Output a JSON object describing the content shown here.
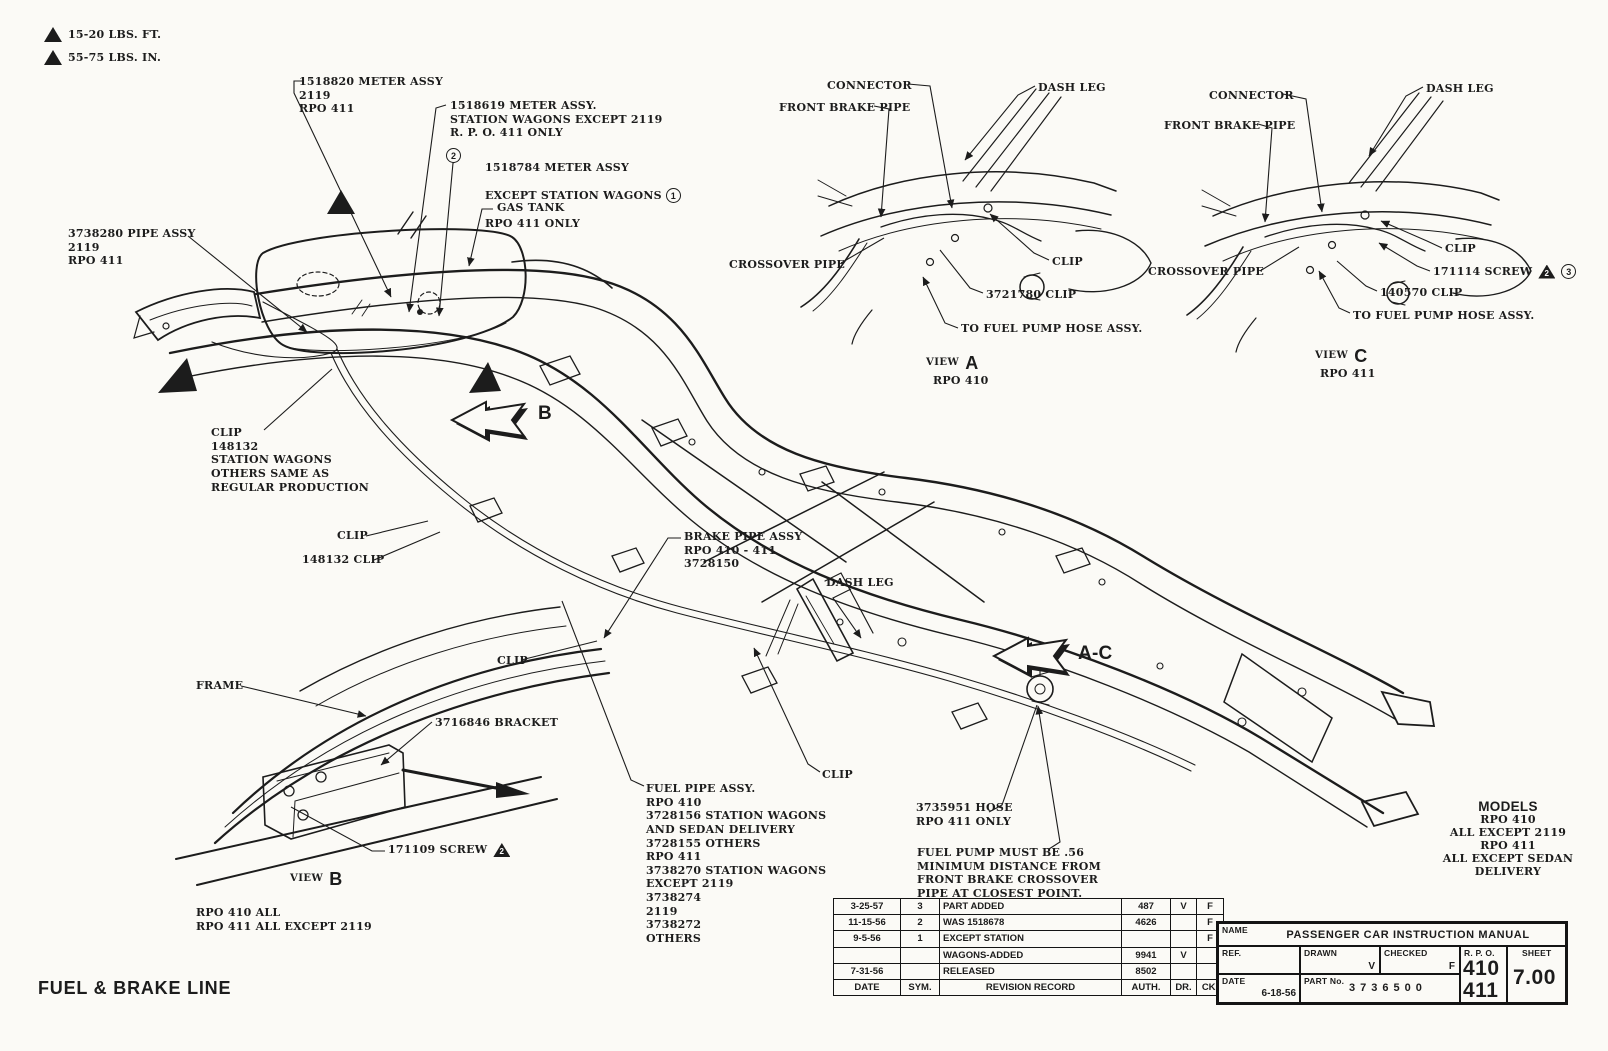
{
  "colors": {
    "paper": "#fbfaf6",
    "ink": "#1c1c1c"
  },
  "legend": {
    "torque_ft": "15-20 LBS. FT.",
    "torque_in": "55-75 LBS. IN."
  },
  "markers": {
    "circle_1": "1",
    "circle_2": "2",
    "circle_3": "3",
    "triangle_2": "2"
  },
  "callouts": {
    "meter_1518820": "1518820 METER ASSY\n2119\nRPO 411",
    "meter_1518619": "1518619 METER ASSY.\nSTATION WAGONS EXCEPT 2119\nR. P. O. 411 ONLY",
    "meter_1518784_l1": "1518784 METER ASSY",
    "meter_1518784_l2": "EXCEPT STATION WAGONS",
    "meter_1518784_l3": "RPO 411 ONLY",
    "gas_tank": "GAS TANK",
    "pipe_3738280": "3738280 PIPE ASSY\n2119\nRPO 411",
    "clip_station_wagons": "CLIP\n148132\nSTATION WAGONS\nOTHERS SAME AS\nREGULAR PRODUCTION",
    "clip_mid": "CLIP",
    "clip_148132": "148132 CLIP",
    "brake_pipe_assy": "BRAKE PIPE ASSY\nRPO 410 - 411\n3728150",
    "dash_leg": "DASH LEG",
    "clip_lower": "CLIP",
    "clip_bottom": "CLIP",
    "fuel_pipe_assy": "FUEL PIPE ASSY.\nRPO 410\n3728156 STATION WAGONS\nAND SEDAN DELIVERY\n3728155 OTHERS\nRPO 411\n3738270 STATION WAGONS\nEXCEPT 2119\n3738274\n2119\n3738272\nOTHERS",
    "hose_3735951": "3735951 HOSE\nRPO 411 ONLY",
    "fuel_pump_note": "FUEL PUMP MUST BE .56\nMINIMUM DISTANCE FROM\nFRONT BRAKE CROSSOVER\nPIPE AT CLOSEST POINT.",
    "arrow_b": "B",
    "arrow_ac": "A-C"
  },
  "view_a": {
    "connector": "CONNECTOR",
    "dash_leg": "DASH LEG",
    "front_brake_pipe": "FRONT BRAKE PIPE",
    "crossover_pipe": "CROSSOVER PIPE",
    "clip": "CLIP",
    "clip_3721780": "3721780 CLIP",
    "to_fuel_pump": "TO FUEL PUMP HOSE ASSY.",
    "view_word": "VIEW",
    "view_letter": "A",
    "rpo": "RPO 410"
  },
  "view_c": {
    "connector": "CONNECTOR",
    "dash_leg": "DASH LEG",
    "front_brake_pipe": "FRONT BRAKE PIPE",
    "crossover_pipe": "CROSSOVER PIPE",
    "clip": "CLIP",
    "screw_171114": "171114 SCREW",
    "clip_140570": "140570 CLIP",
    "to_fuel_pump": "TO FUEL PUMP HOSE ASSY.",
    "view_word": "VIEW",
    "view_letter": "C",
    "rpo": "RPO 411"
  },
  "view_b": {
    "frame": "FRAME",
    "bracket_3716846": "3716846 BRACKET",
    "screw_171109": "171109 SCREW",
    "view_word": "VIEW",
    "view_letter": "B",
    "applicability": "RPO 410 ALL\nRPO 411 ALL EXCEPT 2119"
  },
  "models_block": {
    "title": "MODELS",
    "lines": [
      "RPO 410",
      "ALL EXCEPT 2119",
      "RPO 411",
      "ALL EXCEPT SEDAN",
      "DELIVERY"
    ]
  },
  "drawing_title": "FUEL & BRAKE LINE",
  "revision_table": {
    "headers": [
      "DATE",
      "SYM.",
      "REVISION RECORD",
      "AUTH.",
      "DR.",
      "CK."
    ],
    "rows": [
      [
        "3-25-57",
        "3",
        "PART ADDED",
        "487",
        "V",
        "F"
      ],
      [
        "11-15-56",
        "2",
        "WAS 1518678",
        "4626",
        "",
        "F"
      ],
      [
        "9-5-56",
        "1",
        "EXCEPT STATION",
        "",
        "",
        "F"
      ],
      [
        "",
        "",
        "WAGONS-ADDED",
        "9941",
        "V",
        ""
      ],
      [
        "7-31-56",
        "",
        "RELEASED",
        "8502",
        "",
        ""
      ]
    ]
  },
  "title_block": {
    "name_label": "NAME",
    "name_value": "PASSENGER CAR INSTRUCTION MANUAL",
    "ref_label": "REF.",
    "drawn_label": "DRAWN",
    "drawn_value": "V",
    "checked_label": "CHECKED",
    "checked_value": "F",
    "rpo_label": "R. P. O.",
    "rpo_value_1": "410",
    "rpo_value_2": "411",
    "sheet_label": "SHEET",
    "sheet_value": "7.00",
    "date_label": "DATE",
    "date_value": "6-18-56",
    "part_label": "PART No.",
    "part_value": "3736500"
  }
}
